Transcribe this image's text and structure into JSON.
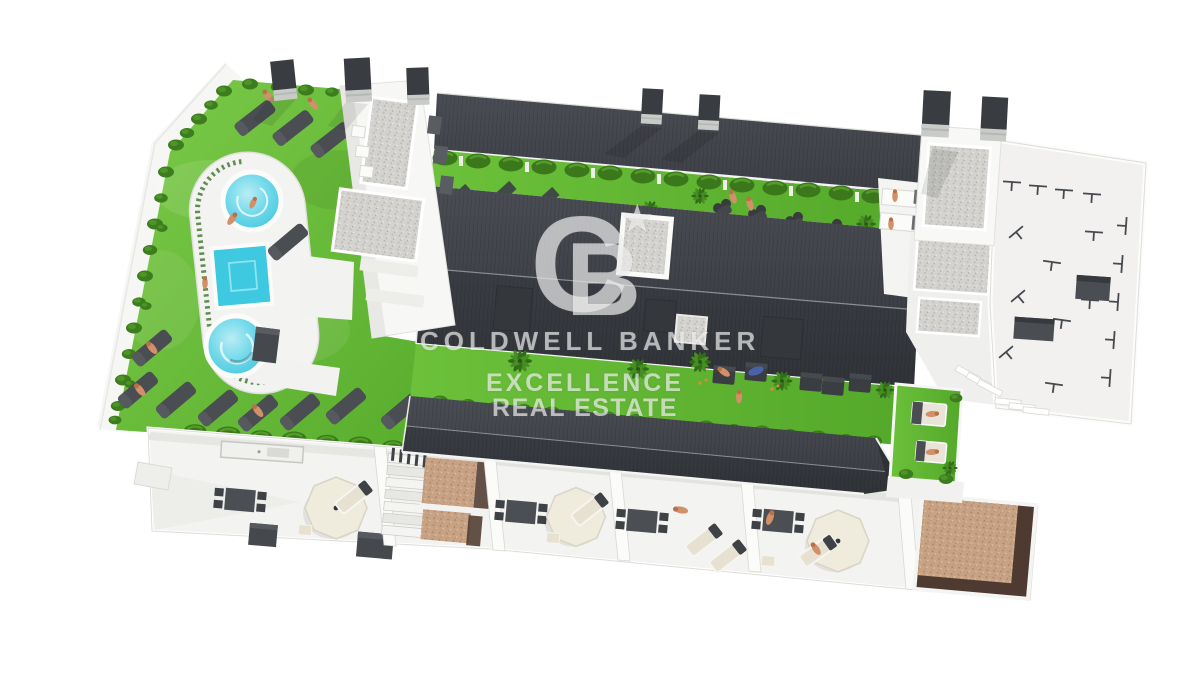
{
  "watermark": {
    "monogram": {
      "letter_c": "C",
      "letter_b": "B",
      "star": "★"
    },
    "brand_line": "COLDWELL BANKER",
    "tagline_line1": "EXCELLENCE",
    "tagline_line2": "REAL ESTATE",
    "color": "rgba(255,255,255,0.62)"
  },
  "palette": {
    "background": "#ffffff",
    "roof_dark": "#3c3f45",
    "grass_green": "#67bd37",
    "hedge_green": "#3a781b",
    "pool_water": "#4fcfe3",
    "deck_white": "#f3f3f1",
    "gravel_gray": "#d3d2ce",
    "patio_tan": "#c7a284",
    "patio_brown": "#4e3a30",
    "furniture_gray": "#4a4d52",
    "furniture_cream": "#e7e1d1"
  },
  "scene": {
    "type": "3d-aerial-render",
    "features": [
      "communal-pool-garden",
      "round-pools",
      "square-pool",
      "sun-loungers",
      "apartment-roofs",
      "roof-chimneys",
      "hedge-rows",
      "palm-planting",
      "dining-terraces",
      "parasols",
      "roof-terrace-railings",
      "gravel-patios"
    ]
  }
}
